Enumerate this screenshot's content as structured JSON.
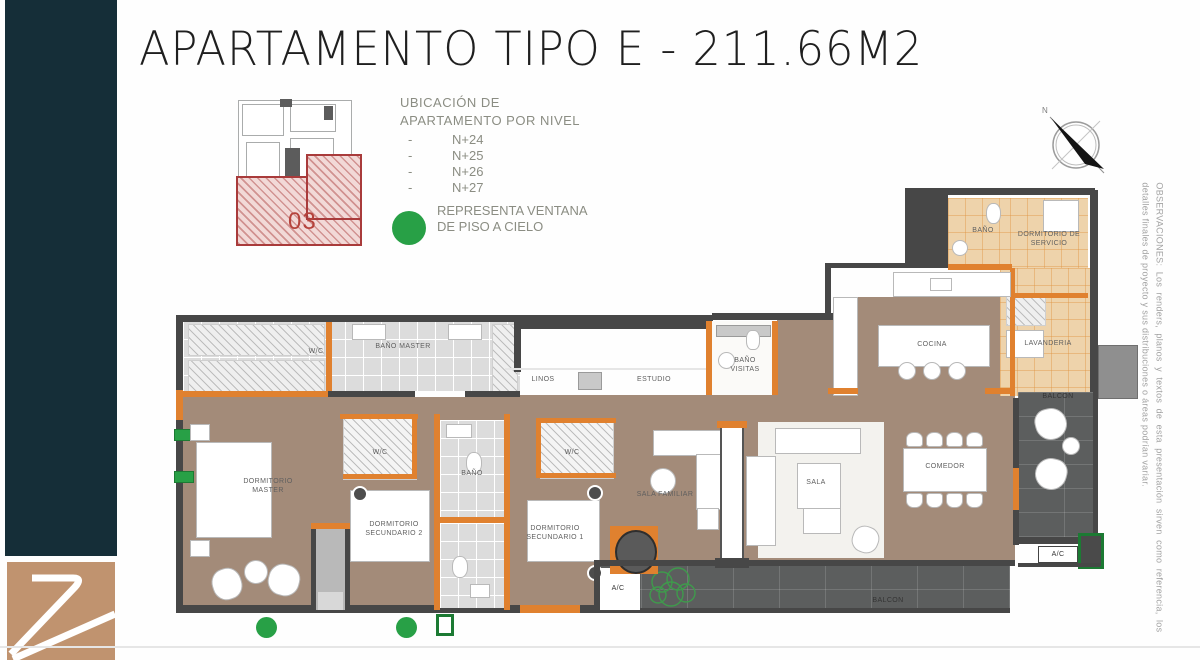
{
  "header": {
    "title": "APARTAMENTO TIPO E - 211.66M2"
  },
  "keyplan": {
    "unit_label": "03"
  },
  "location_info": {
    "line1": "UBICACIÓN DE",
    "line2": "APARTAMENTO POR NIVEL",
    "dash": "-",
    "levels": [
      "N+24",
      "N+25",
      "N+26",
      "N+27"
    ]
  },
  "legend": {
    "window_text": "REPRESENTA VENTANA DE PISO A CIELO"
  },
  "compass": {
    "north_label": "N"
  },
  "observations": {
    "text": "OBSERVACIONES: Los renders, planos y textos de esta presentación sirven como referencia, los detalles finales de proyecto y sus distribuciones o áreas podrían variar."
  },
  "rooms": {
    "wc_master": "W/C",
    "bano_master": "BAÑO MASTER",
    "linos": "LINOS",
    "estudio": "ESTUDIO",
    "bano_visitas": "BAÑO VISITAS",
    "bano_servicio": "BAÑO",
    "dorm_servicio": "DORMITORIO DE SERVICIO",
    "lavanderia": "LAVANDERIA",
    "cocina": "COCINA",
    "balcon_right": "BALCON",
    "balcon_bottom": "BALCON",
    "dorm_master": "DORMITORIO MASTER",
    "wc_2": "W/C",
    "bano_shared": "BAÑO",
    "wc_1": "W/C",
    "dorm_sec_2": "DORMITORIO SECUNDARIO 2",
    "dorm_sec_1": "DORMITORIO SECUNDARIO 1",
    "sala_familiar": "SALA FAMILIAR",
    "sala": "SALA",
    "comedor": "COMEDOR",
    "ac_right": "A/C",
    "ac_bottom": "A/C"
  },
  "colors": {
    "sidebar_teal": "#152e38",
    "logo_bronze": "#c0936f",
    "wall_gray": "#474747",
    "accent_orange": "#e0812f",
    "floor_brown": "#a38b79",
    "service_tan": "#eed3ab",
    "tile_gray": "#dcdcdc",
    "balcony_gray": "#5c5e5e",
    "window_green": "#28a046",
    "unit_red": "#a93b3b"
  }
}
